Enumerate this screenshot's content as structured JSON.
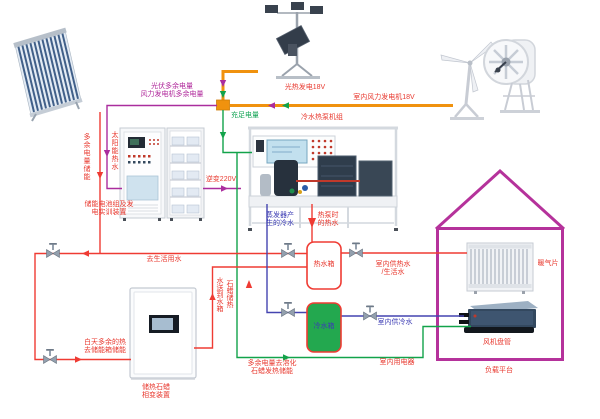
{
  "diagram_title": "太阳能风能热泵综合实训系统图",
  "colors": {
    "surplus_power_line": "#aa2d9e",
    "sufficient_power_line": "#12a34a",
    "generator_bus_line": "#f0920e",
    "hot_water_line": "#ef3b33",
    "cold_water_line": "#4444b0",
    "house_outline": "#b5329b",
    "cold_tank_fill": "#23a84f",
    "label_red": "#e8392f",
    "label_blue": "#3c3cb4"
  },
  "labels": {
    "pv_surplus": "光伏多余电量\n风力发电机多余电量",
    "sufficient_power": "充足电量",
    "pv_generation": "光热发电18V",
    "wind_generation": "室内风力发电机18V",
    "heat_pump_unit": "冷水热泵机组",
    "solar_hot_water": "太阳能热水",
    "surplus_storage": "多余电量储能",
    "battery_device": "储能电池组及发\n电实训装置",
    "inverter": "逆变220V",
    "evaporator_cold": "蒸发器产\n生的冷水",
    "heat_pump_hot": "热泵时\n的热水",
    "to_domestic_water": "去生活用水",
    "hot_tank": "热水箱",
    "cold_tank": "冷水箱",
    "indoor_hot_supply": "室内供热水\n/生活水",
    "indoor_cold_supply": "室内供冷水",
    "paraffin_to_tank": "石蜡储热\n水送到水箱",
    "day_surplus_heat": "白天多余的热\n去储能箱储能",
    "paraffin_device": "储热石蜡\n相变装置",
    "melt_paraffin": "多余电量去溶化\n石蜡发热储能",
    "indoor_appliances": "室内用电器",
    "radiator": "暖气片",
    "fan_coil": "风机盘管",
    "load_platform": "负载平台"
  }
}
